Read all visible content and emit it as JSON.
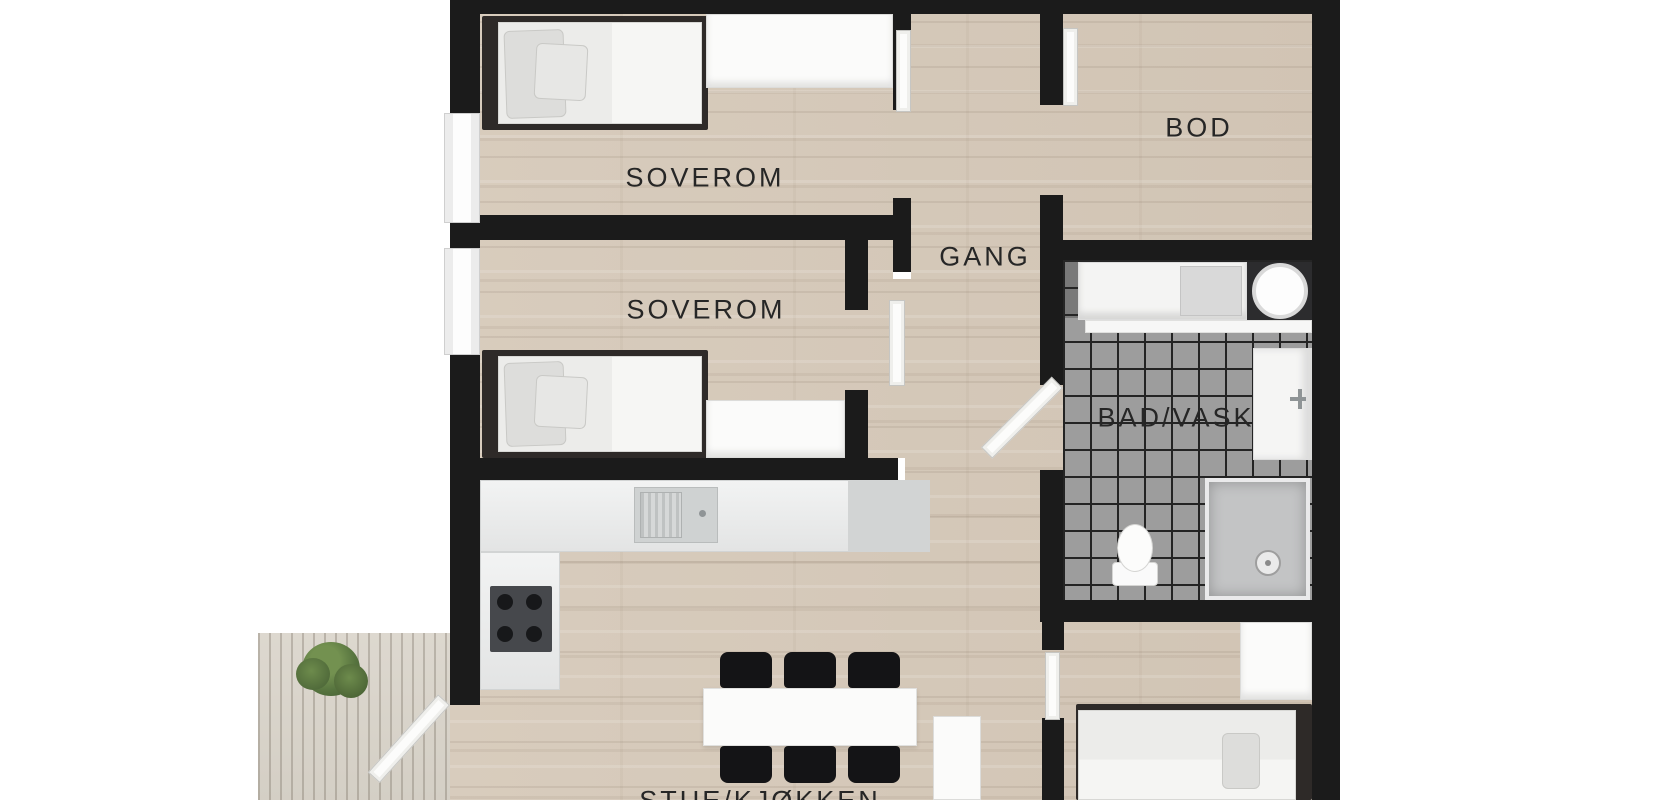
{
  "floorplan": {
    "labels": {
      "bedroom1": "SOVEROM",
      "bedroom2": "SOVEROM",
      "hallway": "GANG",
      "storage": "BOD",
      "bathroom": "BAD/VASK",
      "living_kitchen": "STUE/KJØKKEN"
    },
    "colors": {
      "wall": "#1b1b1b",
      "wood_floor": "#d5c8b8",
      "tile_floor": "#9d9d9d",
      "deck": "#dad5cb",
      "label_text": "#262626",
      "plant_green": "#5a7742",
      "furniture_dark": "#141416",
      "furniture_white": "#fbfbfa"
    },
    "furniture_icons": [
      "bed-icon",
      "closet-icon",
      "kitchen-counter-icon",
      "sink-icon",
      "cooktop-icon",
      "dining-table-icon",
      "chair-icon",
      "washing-machine-icon",
      "vanity-icon",
      "shower-icon",
      "toilet-icon",
      "wardrobe-icon",
      "plant-icon",
      "door-icon",
      "window-icon"
    ]
  }
}
